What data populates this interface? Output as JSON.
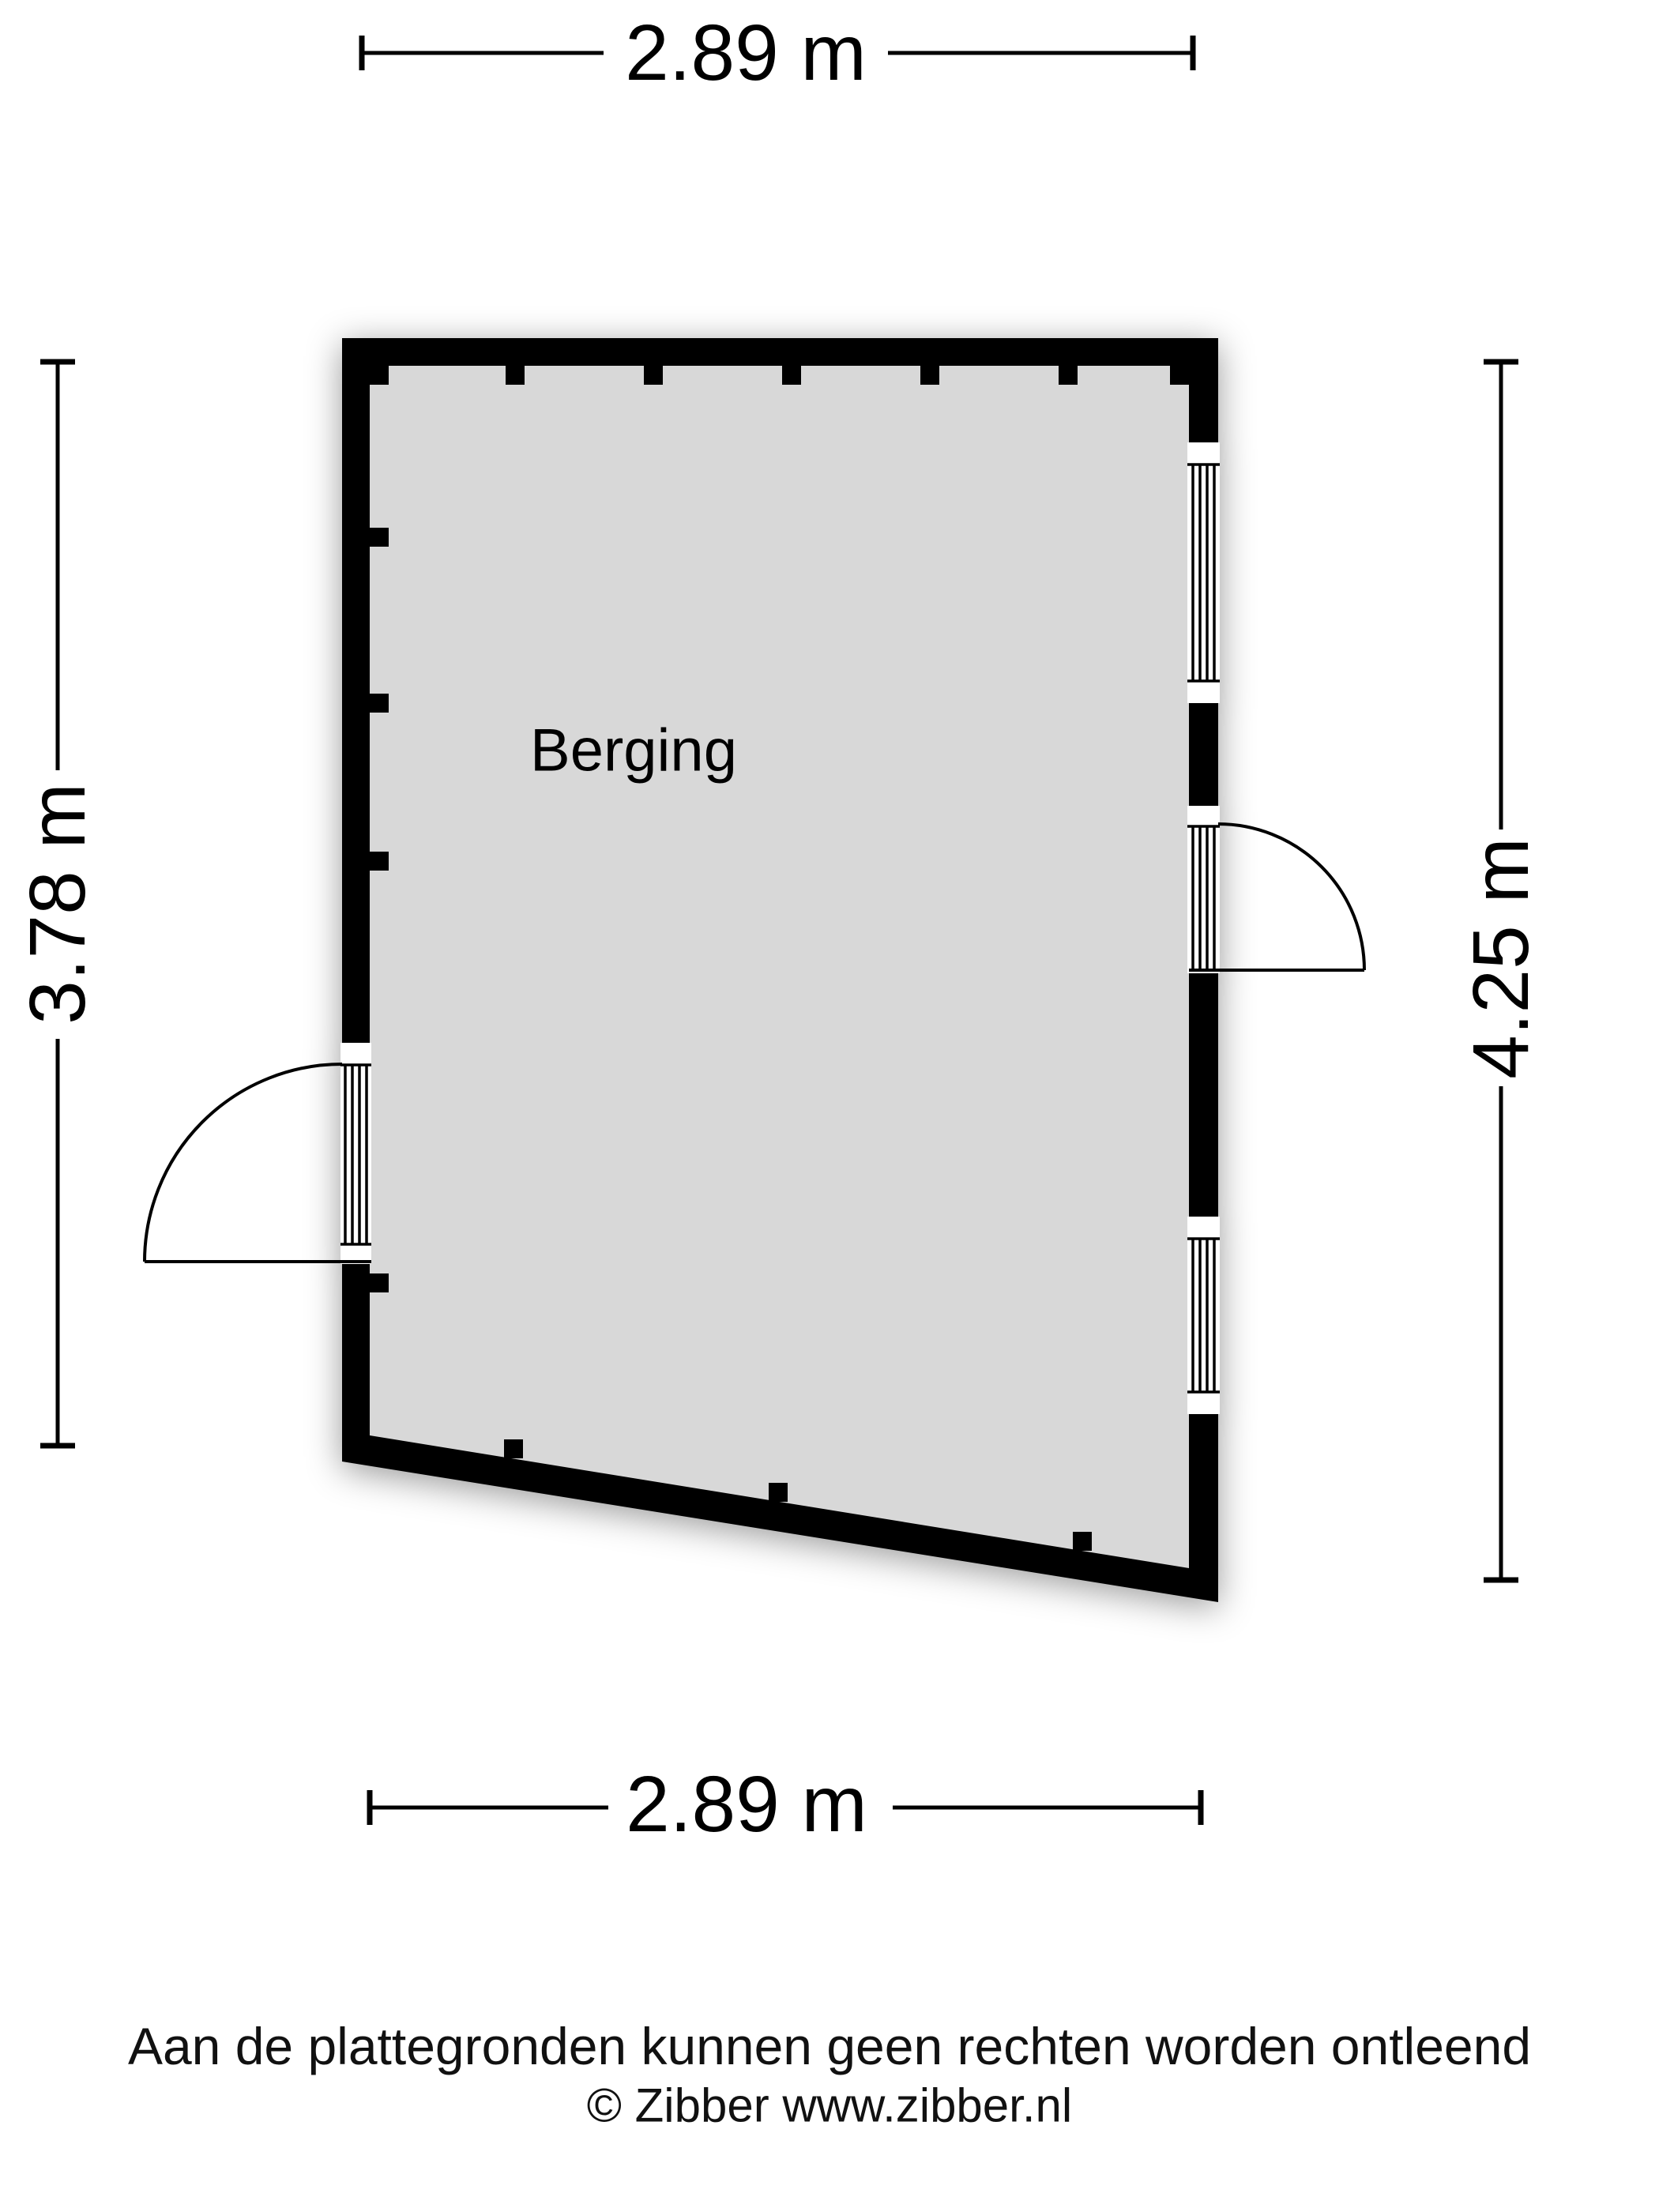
{
  "room": {
    "label": "Berging"
  },
  "dimensions": {
    "top": "2.89 m",
    "bottom": "2.89 m",
    "left": "3.78 m",
    "right": "4.25 m"
  },
  "footer": {
    "disclaimer": "Aan de plattegronden kunnen geen rechten worden ontleend",
    "copyright": "© Zibber www.zibber.nl"
  },
  "colors": {
    "wall": "#000000",
    "floor": "#d8d8d8",
    "background": "#ffffff",
    "line": "#000000"
  }
}
